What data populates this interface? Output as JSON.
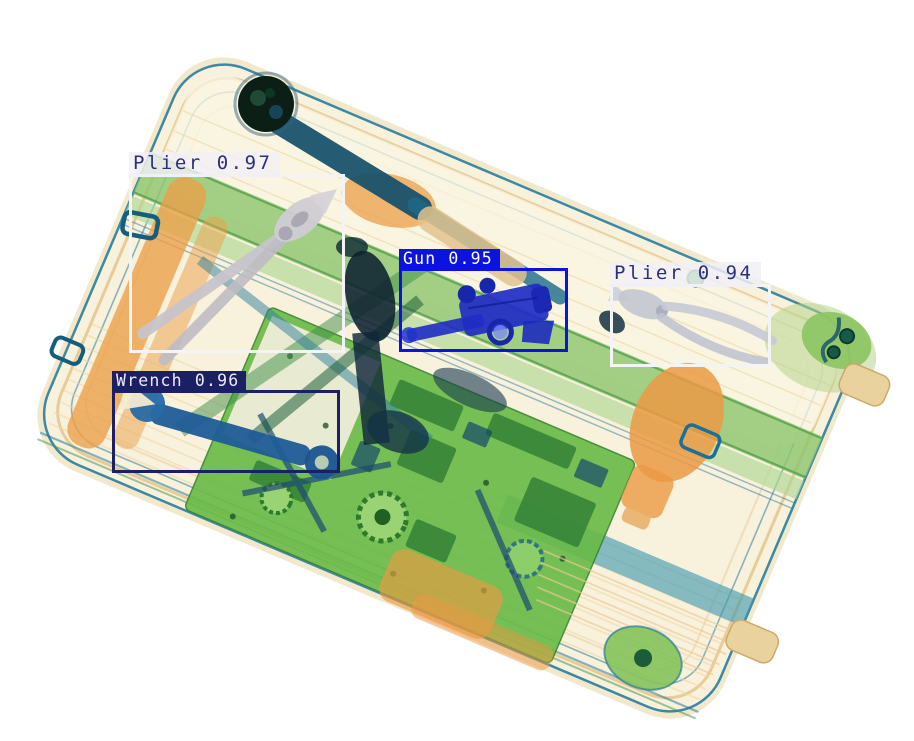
{
  "image": {
    "alt": "X-ray security scan of a suitcase containing a gun, two pliers, a wrench and electronics, with object-detection bounding boxes",
    "width": 914,
    "height": 741,
    "background_color": "#ffffff"
  },
  "scene_colors": {
    "shell_cream": "#f8f1dc",
    "shell_trim_orange": "#e3c68c",
    "piping_teal": "#2e7d9a",
    "strap_green": "#8cc56d",
    "board_green": "#68ba46",
    "organic_orange": "#eb9f48",
    "metal_dark": "#14506b",
    "gun_blue": "#1e2cc4",
    "plier_gray": "#c7c4cb",
    "wrench_steel": "#1f5c97"
  },
  "themes": {
    "light": {
      "border": "#f4f3f6",
      "label_bg": "rgba(241,240,246,0.84)",
      "text": "#2b2f7e"
    },
    "blue": {
      "border": "#0c13de",
      "label_bg": "#0c13de",
      "text": "#ffffff"
    },
    "navy": {
      "border": "#1b2065",
      "label_bg": "#1b2065",
      "text": "#eceafc"
    }
  },
  "detections": [
    {
      "label": "Plier",
      "score": "0.97",
      "theme": "light",
      "box": {
        "left": 129,
        "top": 174,
        "width": 216,
        "height": 179
      }
    },
    {
      "label": "Gun",
      "score": "0.95",
      "theme": "blue",
      "box": {
        "left": 399,
        "top": 268,
        "width": 169,
        "height": 84
      }
    },
    {
      "label": "Plier",
      "score": "0.94",
      "theme": "light",
      "box": {
        "left": 610,
        "top": 284,
        "width": 161,
        "height": 83
      }
    },
    {
      "label": "Wrench",
      "score": "0.96",
      "theme": "navy",
      "box": {
        "left": 112,
        "top": 390,
        "width": 228,
        "height": 83
      }
    }
  ]
}
